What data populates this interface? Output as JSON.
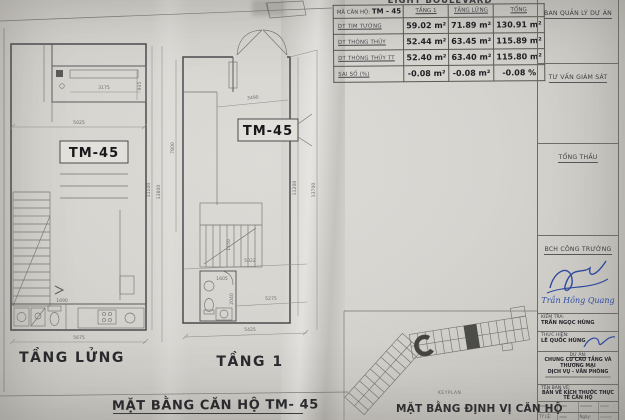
{
  "meta": {
    "project_title_partial": "EIGHT BOULEVARD"
  },
  "area_table": {
    "header": {
      "unit_label": "MÃ CĂN HỘ:",
      "unit_code": "TM - 45",
      "cols": [
        "TẦNG 1",
        "TẦNG LỬNG",
        "TỔNG"
      ]
    },
    "rows": [
      {
        "label": "DT TIM TƯỜNG",
        "tang1": "59.02 m²",
        "tang_lung": "71.89 m²",
        "tong": "130.91 m²"
      },
      {
        "label": "DT THÔNG THỦY",
        "tang1": "52.44 m²",
        "tang_lung": "63.45 m²",
        "tong": "115.89 m²"
      },
      {
        "label": "DT THÔNG THỦY TT",
        "tang1": "52.40 m²",
        "tang_lung": "63.40 m²",
        "tong": "115.80 m²"
      },
      {
        "label": "SAI SỐ (%)",
        "tang1": "-0.08 m²",
        "tang_lung": "-0.08 m²",
        "tong": "-0.08 %"
      }
    ]
  },
  "side_panels": {
    "labels": [
      "BAN QUẢN LÝ DỰ ÁN",
      "TƯ VẤN GIÁM SÁT",
      "TỔNG THẦU",
      "BCH CÔNG TRƯỜNG"
    ]
  },
  "signature_block": {
    "site_manager_name": "Trần Hồng Quang"
  },
  "title_block": {
    "check_label": "KIỂM TRA:",
    "check_name": "TRẦN NGỌC HÙNG",
    "make_label": "THỰC HIỆN:",
    "make_name": "LÊ QUỐC HÙNG",
    "project_label": "DỰ ÁN:",
    "project_line1": "CHUNG CƯ CAO TẦNG VÀ THƯƠNG MẠI",
    "project_line2": "DỊCH VỤ - VĂN PHÒNG",
    "drawing_label": "TÊN BẢN VẼ:",
    "drawing_name": "BẢN VẼ KÍCH THƯỚC THỰC TẾ CĂN HỘ",
    "scale_label": "TỶ LỆ:",
    "date_label": "Ngày:"
  },
  "plans": {
    "mezzanine": {
      "label": "TẦNG LỬNG",
      "unit": "TM-45",
      "dims": {
        "balcony_width": "3175",
        "balcony_depth": "935",
        "upper_width": "5025",
        "wc_width": "1690",
        "total_width": "5675",
        "inner_height": "11100",
        "total_height": "13800"
      }
    },
    "floor1": {
      "label": "TẦNG 1",
      "unit": "TM-45",
      "dims": {
        "entry_width": "3490",
        "left_height": "7800",
        "stair_width": "1150",
        "mid_width": "5022",
        "wc_width": "1605",
        "wc_depth": "2040",
        "lower_width": "5275",
        "total_width": "5425",
        "inner_height": "11200",
        "total_height": "13700"
      }
    }
  },
  "keyplan": {
    "caption": "KEYPLAN",
    "label": "MẶT BẰNG ĐỊNH VỊ CĂN HỘ"
  },
  "footer": {
    "main_label": "MẶT BẰNG CĂN HỘ TM- 45"
  }
}
